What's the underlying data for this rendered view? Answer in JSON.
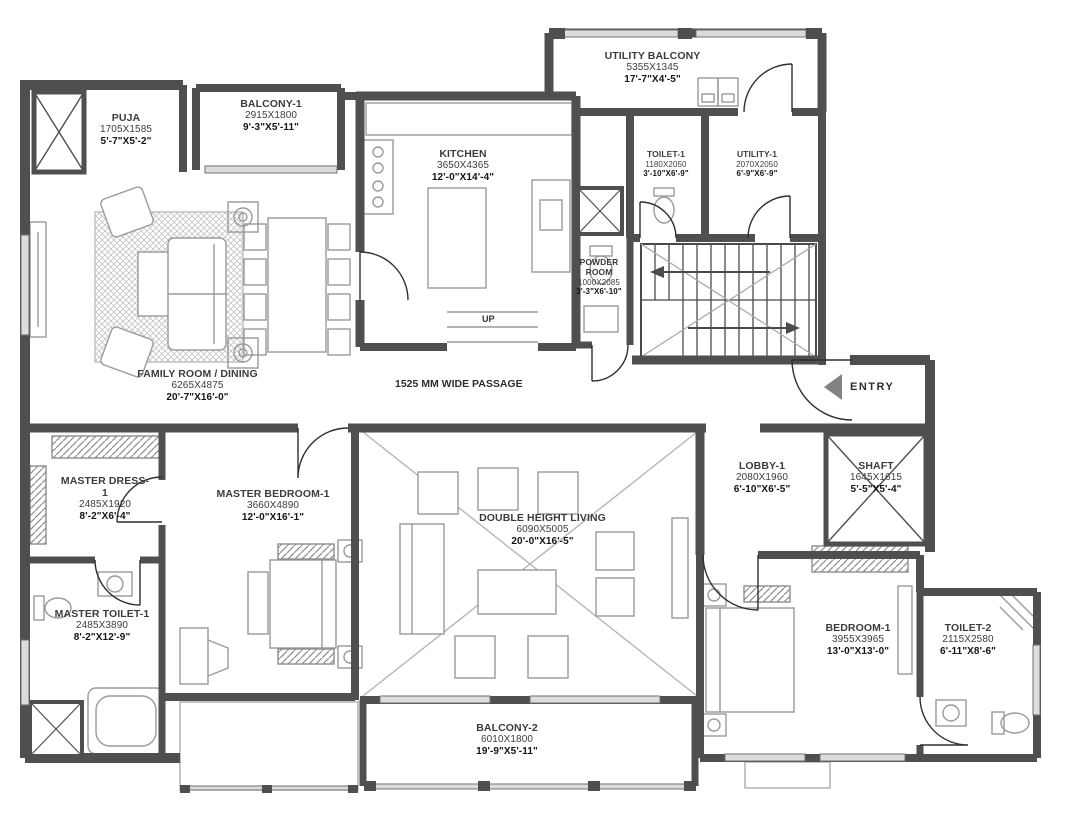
{
  "labels": {
    "passage": "1525 MM WIDE PASSAGE",
    "entry": "ENTRY",
    "up": "UP"
  },
  "colors": {
    "wall": "#4f4f4f",
    "furniture": "#9a9a9a",
    "text": "#3c3c3c"
  },
  "rooms": [
    {
      "name": "PUJA",
      "mm": "1705X1585",
      "ft": "5'-7\"X5'-2\""
    },
    {
      "name": "BALCONY-1",
      "mm": "2915X1800",
      "ft": "9'-3\"X5'-11\""
    },
    {
      "name": "KITCHEN",
      "mm": "3650X4365",
      "ft": "12'-0\"X14'-4\""
    },
    {
      "name": "UTILITY BALCONY",
      "mm": "5355X1345",
      "ft": "17'-7\"X4'-5\""
    },
    {
      "name": "TOILET-1",
      "mm": "1180X2050",
      "ft": "3'-10\"X6'-9\""
    },
    {
      "name": "UTILITY-1",
      "mm": "2070X2050",
      "ft": "6'-9\"X6'-9\""
    },
    {
      "name": "POWDER ROOM",
      "mm": "1000X2085",
      "ft": "3'-3\"X6'-10\""
    },
    {
      "name": "FAMILY ROOM / DINING",
      "mm": "6265X4875",
      "ft": "20'-7\"X16'-0\""
    },
    {
      "name": "MASTER DRESS-1",
      "mm": "2485X1920",
      "ft": "8'-2\"X6'-4\""
    },
    {
      "name": "MASTER BEDROOM-1",
      "mm": "3660X4890",
      "ft": "12'-0\"X16'-1\""
    },
    {
      "name": "DOUBLE HEIGHT LIVING",
      "mm": "6090X5005",
      "ft": "20'-0\"X16'-5\""
    },
    {
      "name": "LOBBY-1",
      "mm": "2080X1960",
      "ft": "6'-10\"X6'-5\""
    },
    {
      "name": "SHAFT",
      "mm": "1645X1615",
      "ft": "5'-5\"X5'-4\""
    },
    {
      "name": "MASTER TOILET-1",
      "mm": "2485X3890",
      "ft": "8'-2\"X12'-9\""
    },
    {
      "name": "BEDROOM-1",
      "mm": "3955X3965",
      "ft": "13'-0\"X13'-0\""
    },
    {
      "name": "TOILET-2",
      "mm": "2115X2580",
      "ft": "6'-11\"X8'-6\""
    },
    {
      "name": "BALCONY-2",
      "mm": "6010X1800",
      "ft": "19'-9\"X5'-11\""
    }
  ]
}
